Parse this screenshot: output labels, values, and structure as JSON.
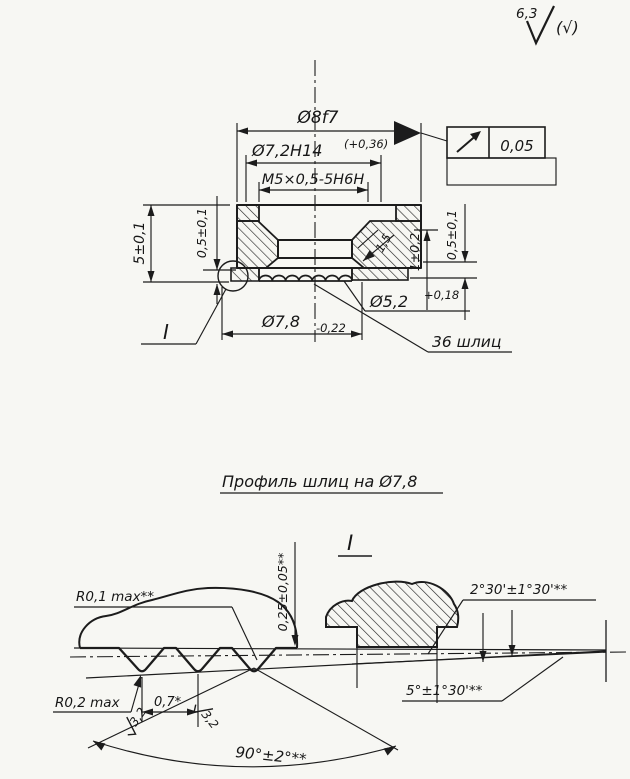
{
  "drawing": {
    "roughness_general": {
      "value": "6,3",
      "alt": "(√)"
    },
    "main_view": {
      "dim_outer": "Ø8f7",
      "dim_counterbore": "Ø7,2H14",
      "dim_counterbore_tol": "(+0,36)",
      "dim_thread": "M5×0,5-5H6H",
      "runout_tol": "0,05",
      "dim_height": "5±0,1",
      "dim_lip_left": "0,5±0,1",
      "dim_chamfer": "1,5",
      "dim_step": "1±0,2",
      "dim_lip_right": "0,5±0,1",
      "dim_spline_minor": "Ø5,2",
      "dim_spline_minor_tol": "+0,18",
      "dim_spline_major": "Ø7,8",
      "dim_spline_major_tol": "-0,22",
      "spline_count_note": "36 шлиц",
      "detail_callout": "I"
    },
    "detail_view": {
      "title": "Профиль шлиц на Ø7,8",
      "label": "I",
      "dim_root_radius": "R0,1 max**",
      "dim_profile_height": "0,25±0,05**",
      "dim_angle_tip": "2°30'±1°30'**",
      "dim_angle_taper": "5°±1°30'**",
      "dim_tip_radius": "R0,2 max",
      "dim_pitch": "0,7*",
      "flank_roughness": "3,2",
      "dim_profile_angle": "90°±2°**"
    }
  }
}
